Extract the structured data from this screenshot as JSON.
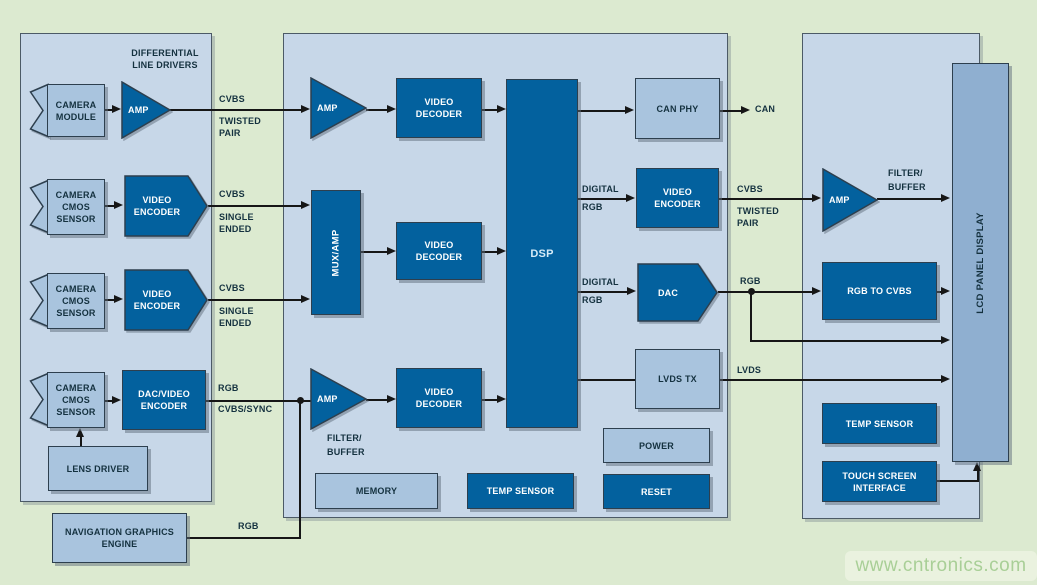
{
  "colors": {
    "background_green": "#dcead0",
    "panel_blue": "#c7d7e8",
    "block_dark_blue": "#03619e",
    "block_light_blue": "#a9c4de",
    "lcd_blue": "#8fafd0",
    "line_black": "#161616",
    "label_text": "#14313f",
    "watermark_green": "#a9cf97"
  },
  "left": {
    "title": "DIFFERENTIAL LINE DRIVERS",
    "row1": {
      "block": "CAMERA MODULE",
      "device": "AMP",
      "sig_top": "CVBS",
      "sig_bottom": "TWISTED PAIR"
    },
    "row2": {
      "block": "CAMERA CMOS SENSOR",
      "device": "VIDEO ENCODER",
      "sig_top": "CVBS",
      "sig_bottom": "SINGLE ENDED"
    },
    "row3": {
      "block": "CAMERA CMOS SENSOR",
      "device": "VIDEO ENCODER",
      "sig_top": "CVBS",
      "sig_bottom": "SINGLE ENDED"
    },
    "row4": {
      "block": "CAMERA CMOS SENSOR",
      "device": "DAC/VIDEO ENCODER",
      "sig_top": "RGB",
      "sig_bottom": "CVBS/SYNC"
    },
    "lens_driver": "LENS DRIVER"
  },
  "middle": {
    "amp1": "AMP",
    "vd1": "VIDEO DECODER",
    "muxamp": "MUX/AMP",
    "vd2": "VIDEO DECODER",
    "amp3": "AMP",
    "amp3_caption": "FILTER/ BUFFER",
    "vd3": "VIDEO DECODER",
    "dsp": "DSP",
    "can_phy": "CAN PHY",
    "can_out": "CAN",
    "enc": "VIDEO ENCODER",
    "enc_in_top": "DIGITAL",
    "enc_in_bottom": "RGB",
    "enc_out_top": "CVBS",
    "enc_out_bottom": "TWISTED PAIR",
    "dac": "DAC",
    "dac_in_top": "DIGITAL",
    "dac_in_bottom": "RGB",
    "dac_out": "RGB",
    "lvds_tx": "LVDS TX",
    "lvds_out": "LVDS",
    "power": "POWER",
    "reset": "RESET",
    "memory": "MEMORY",
    "temp_sensor": "TEMP SENSOR"
  },
  "right": {
    "amp": "AMP",
    "amp_caption": "FILTER/ BUFFER",
    "rgb_to_cvbs": "RGB TO CVBS",
    "lcd": "LCD PANEL DISPLAY",
    "temp_sensor": "TEMP SENSOR",
    "touch": "TOUCH SCREEN INTERFACE"
  },
  "bottom": {
    "nav": "NAVIGATION GRAPHICS ENGINE",
    "nav_sig": "RGB"
  },
  "watermark": {
    "text": "www.cntronics.com"
  }
}
